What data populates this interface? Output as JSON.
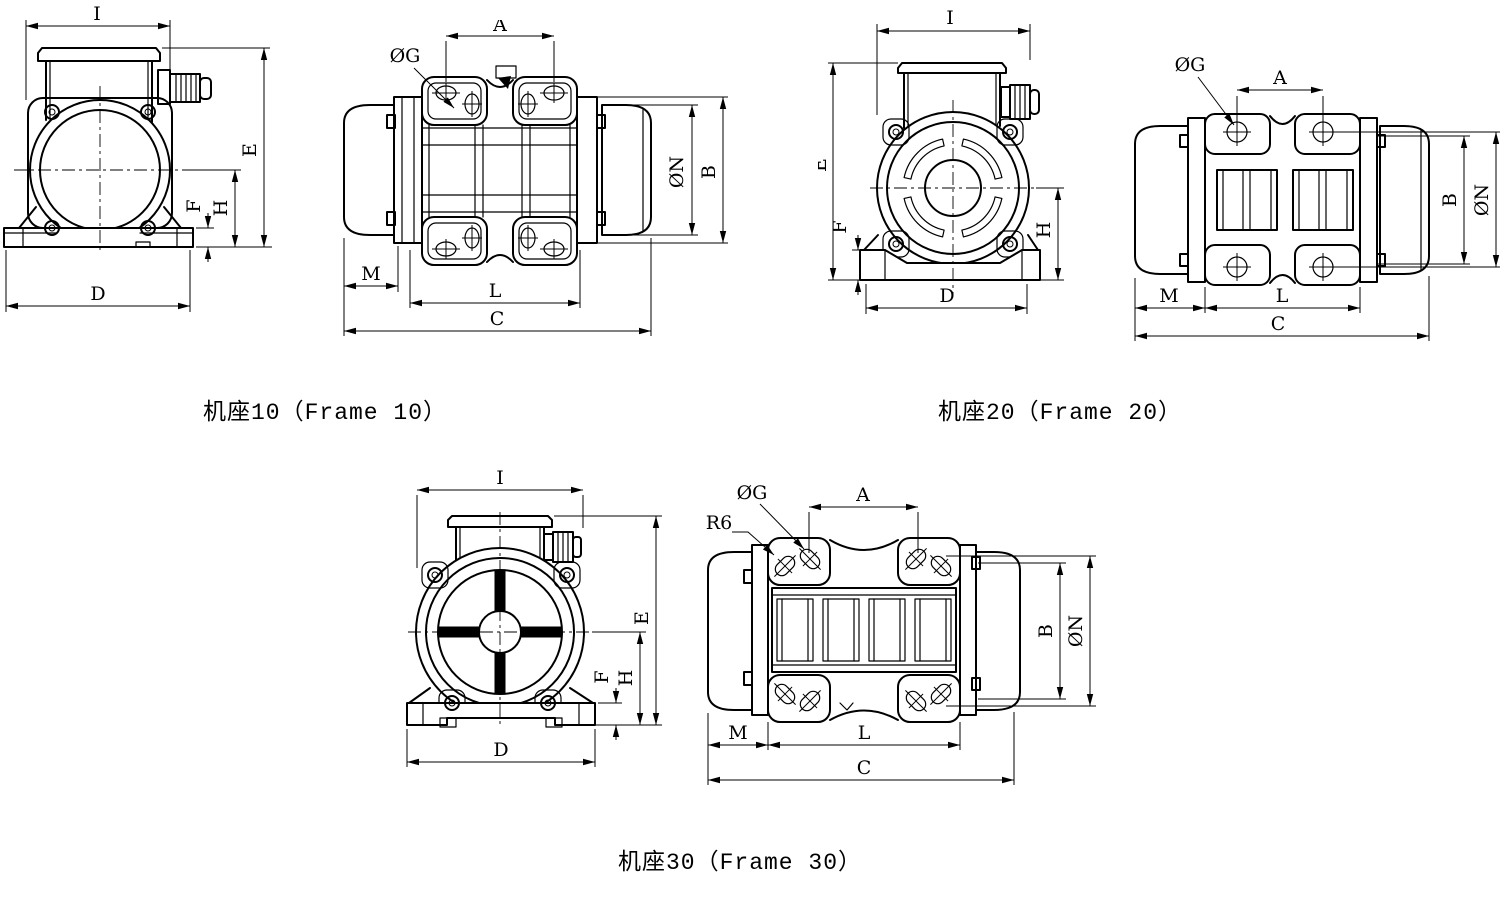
{
  "page": {
    "background_color": "#ffffff",
    "line_color": "#000000",
    "description": "Vibration motor outline dimension drawing, three frame sizes, each with front view and side view"
  },
  "figures": [
    {
      "caption": "机座10（Frame 10）",
      "front": {
        "I": "I",
        "E": "E",
        "F": "F",
        "H": "H",
        "D": "D"
      },
      "side": {
        "A": "A",
        "OG": "ØG",
        "ON": "ØN",
        "B": "B",
        "M": "M",
        "L": "L",
        "C": "C"
      }
    },
    {
      "caption": "机座20（Frame 20）",
      "front": {
        "I": "I",
        "E": "E",
        "F": "F",
        "H": "H",
        "D": "D"
      },
      "side": {
        "A": "A",
        "OG": "ØG",
        "ON": "ØN",
        "B": "B",
        "M": "M",
        "L": "L",
        "C": "C"
      }
    },
    {
      "caption": "机座30（Frame 30）",
      "front": {
        "I": "I",
        "E": "E",
        "F": "F",
        "H": "H",
        "D": "D"
      },
      "side": {
        "A": "A",
        "OG": "ØG",
        "R6": "R6",
        "ON": "ØN",
        "B": "B",
        "M": "M",
        "L": "L",
        "C": "C"
      }
    }
  ]
}
